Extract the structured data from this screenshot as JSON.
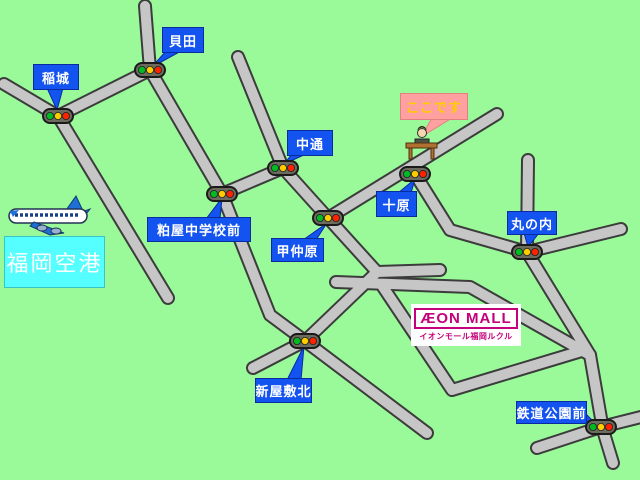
{
  "colors": {
    "background": "#9afa9a",
    "road_fill": "#c6c6c6",
    "road_outline": "#3c3c3c",
    "label_bg": "#1353f0",
    "label_border": "#0a2aa0",
    "label_text": "#ffffff",
    "here_bg": "#ffa0a0",
    "here_text": "#ffcc00",
    "airport_bg": "#55ffff",
    "airport_text": "#ffffff",
    "brand_magenta": "#c4007a",
    "traffic_green": "#00bb22",
    "traffic_yellow": "#ffcc00",
    "traffic_red": "#ff2200"
  },
  "here_label": {
    "text": "ここです"
  },
  "airport": {
    "name": "福岡空港"
  },
  "aeon": {
    "brand": "ÆON MALL",
    "subtitle": "イオンモール福岡ルクル"
  },
  "labels": {
    "inagi": {
      "text": "稲城"
    },
    "kaida": {
      "text": "貝田"
    },
    "nakadori": {
      "text": "中通"
    },
    "kasuya_chugakko_mae": {
      "text": "粕屋中学校前"
    },
    "konakabaru": {
      "text": "甲仲原"
    },
    "tohara": {
      "text": "十原"
    },
    "marunouchi": {
      "text": "丸の内"
    },
    "shinyashiki_kita": {
      "text": "新屋敷北"
    },
    "tetsudo_koen_mae": {
      "text": "鉄道公園前"
    }
  },
  "icons": {
    "traffic_light": "traffic-light-icon",
    "airplane": "airplane-icon",
    "destination": "person-at-desk-icon"
  }
}
